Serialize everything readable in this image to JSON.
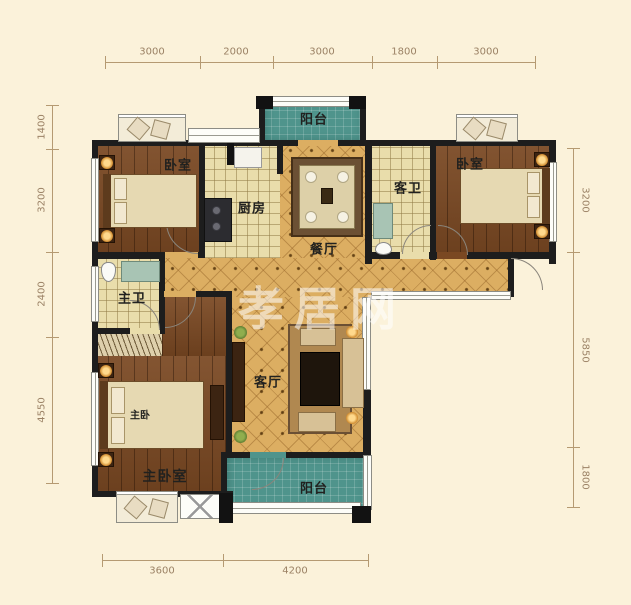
{
  "floorplan": {
    "watermark": "孝居网",
    "rooms": {
      "balcony_top": "阳台",
      "bedroom_left": "卧室",
      "kitchen": "厨房",
      "dining": "餐厅",
      "guest_bath": "客卫",
      "bedroom_right": "卧室",
      "master_bath": "主卫",
      "living": "客厅",
      "master_bed": "主卧",
      "master_bedroom": "主卧室",
      "balcony_bottom": "阳台"
    },
    "dimensions": {
      "top": [
        "3000",
        "2000",
        "3000",
        "1800",
        "3000"
      ],
      "left": [
        "1400",
        "3200",
        "2400",
        "4550"
      ],
      "right": [
        "3200",
        "5850",
        "1800"
      ],
      "bottom": [
        "3600",
        "4200"
      ]
    },
    "colors": {
      "background": "#fbf2da",
      "wall": "#1d1d1d",
      "wood_floor": "#7a4822",
      "tile_floor": "#e9ddab",
      "diamond_floor": "#dcae62",
      "balcony_floor": "#4f948c",
      "dimension_text": "#9b8265"
    }
  }
}
